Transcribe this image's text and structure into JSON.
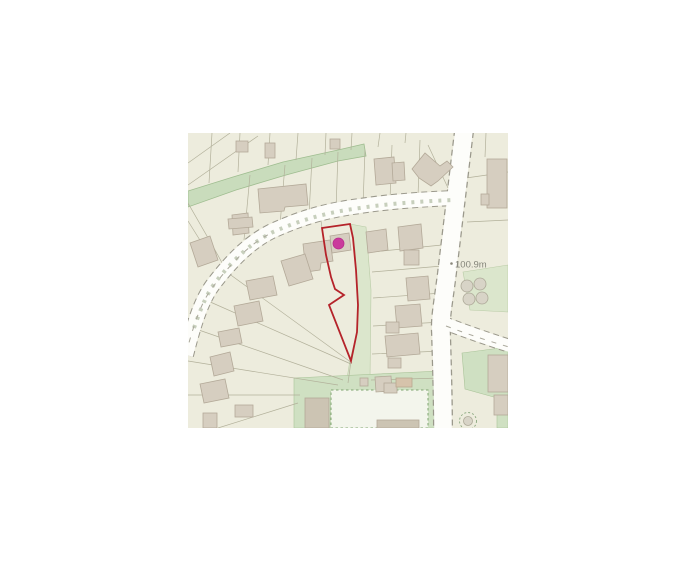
{
  "map": {
    "kind": "property-site-plan",
    "labels": {
      "spot_height": "100.9m"
    },
    "colors": {
      "map_background": "#edecdd",
      "building_fill": "#d6cec0",
      "building_stroke": "#b3a998",
      "road_fill": "#fdfdfa",
      "road_casing": "#9a988b",
      "green_strip": "#c9dcbc",
      "pale_green": "#dbe6cc",
      "plot_boundary": "#b5232a",
      "marker": "#ca3a9c",
      "parcel_line": "#b2b09a",
      "label_text": "#85857a"
    }
  }
}
